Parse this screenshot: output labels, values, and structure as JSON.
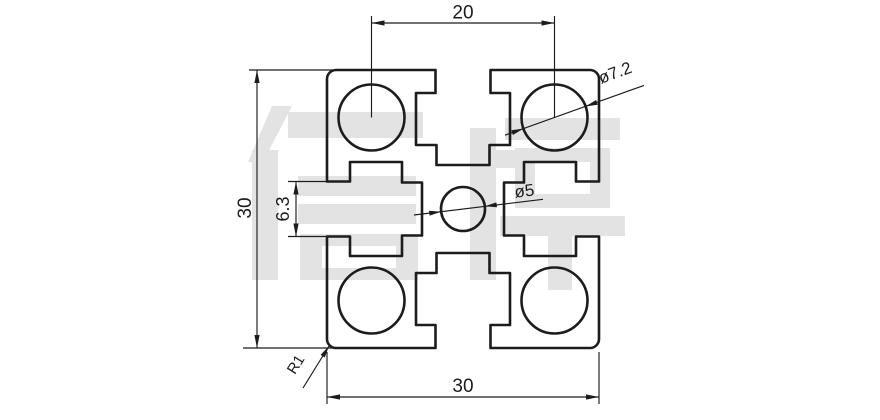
{
  "drawing": {
    "type": "technical-drawing",
    "subject": "30x30 aluminium T-slot extrusion profile cross-section",
    "watermark_text": "信牌",
    "colors": {
      "line": "#1c1c1c",
      "watermark": "#e3e3e3",
      "background": "#ffffff"
    },
    "dimensions": {
      "bore_pitch": "20",
      "overall_height": "30",
      "slot_opening": "6.3",
      "overall_width": "30",
      "corner_bore_diameter": "ø7.2",
      "center_bore_diameter": "ø5",
      "corner_radius": "R1"
    }
  }
}
